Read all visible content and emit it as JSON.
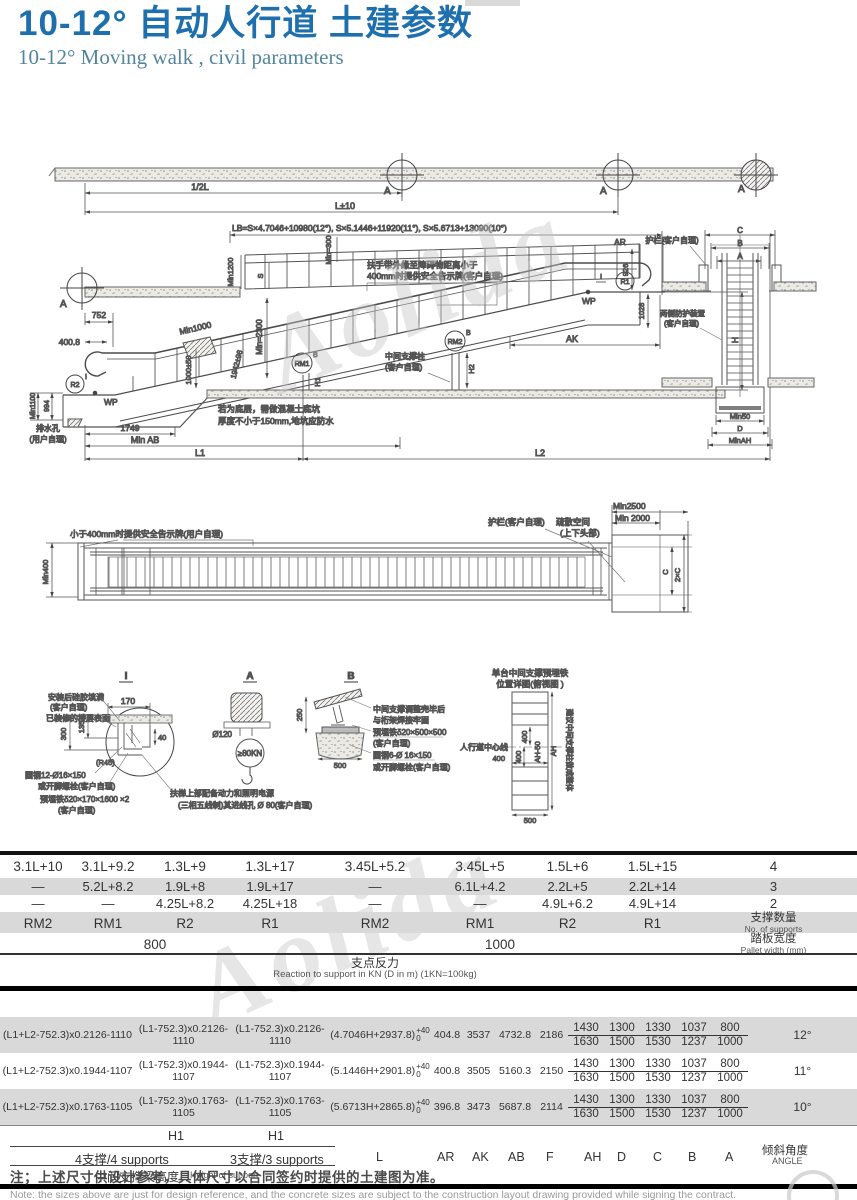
{
  "colors": {
    "title_blue": "#1e6fae",
    "subtitle_blue": "#54859e",
    "band_gray": "#d9d9d9",
    "line_dark": "#1a1a1a"
  },
  "watermark": "Aolida",
  "header": {
    "title_main": "10-12° 自动人行道",
    "title_sub": "土建参数",
    "subtitle": "10-12°  Moving walk , civil parameters"
  },
  "elevation": {
    "a_marker": "A",
    "dim_half_l": "1/2L",
    "dim_l": "L±10",
    "lb_formula": "LB=S×4.7046+10980(12°),  S×5.1446+11920(11°), S×5.6713+13090(10°)",
    "min1200": "Min1200",
    "s": "S",
    "min300": "Min=300",
    "handrail_note_1": "扶手带外缘至障碍物距离小于",
    "handrail_note_2": "400mm时提供安全告示牌(客户自理)",
    "min2300": "Min=2300",
    "min1000": "Min1000",
    "pit_depth": "1000±50",
    "incline_dim": "1942±98",
    "dim_752": "752",
    "dim_400_8": "400.8",
    "min1100": "Min1100",
    "dim_994": "994",
    "wp": "WP",
    "r2": "R2",
    "sup_i": "I",
    "r1": "R1",
    "rm1": "RM1",
    "rm2": "RM2",
    "sup_b": "B",
    "marker_i": "I",
    "drain_1": "排水孔",
    "drain_2": "(用户自理)",
    "dim_1749": "1749",
    "min_ab": "Min AB",
    "l1": "L1",
    "l2": "L2",
    "pit_note_1": "若为底层，需做混凝土底坑",
    "pit_note_2": "厚度不小于150mm,地坑应防水",
    "mid_col_1": "中间支撑柱",
    "mid_col_2": "(客户自理)",
    "h1": "H1",
    "h2": "H2",
    "ar": "AR",
    "dim_926": "926",
    "dim_1028": "1028",
    "ak": "AK",
    "h": "H"
  },
  "section": {
    "guardrail": "护栏(客户自理)",
    "c": "C",
    "b": "B",
    "a": "A",
    "side_1": "两侧防护装置",
    "side_2": "(客户自理)",
    "min50": "Min50",
    "d": "D",
    "min_ah": "MinAH"
  },
  "plan": {
    "sign_note": "小于400mm时提供安全告示牌(用户自理)",
    "min400": "Min400",
    "guardrail": "护栏(客户自理)",
    "evac_1": "疏散空间",
    "evac_2": "(上下头部)",
    "min2500": "Min2500",
    "min2000": "Min 2000",
    "c": "C",
    "c2": "2×C"
  },
  "details": {
    "i": {
      "title": "I",
      "silicone_1": "安装后硅胶填满",
      "silicone_2": "(客户自理)",
      "floor": "已装修的楼层表面",
      "d170": "170",
      "d135": "135",
      "d300": "300",
      "d40": "40",
      "r45": "(R45)",
      "rod": "圆钢12-Ø16×150",
      "bolt": "或开脚螺栓(客户自理)",
      "plate": "预埋铁δ20×170×1600 ×2",
      "owner": "(客户自理)",
      "power_1": "扶梯上部配备动力和照明电源",
      "power_2": "(三相五线制)其进线孔 Ø 80(客户自理)"
    },
    "a": {
      "title": "A",
      "d120": "Ø120",
      "load": "≥80KN"
    },
    "b": {
      "title": "B",
      "d250": "250",
      "d500": "500",
      "weld_1": "中间支撑调整完毕后",
      "weld_2": "与桁架焊接牢固",
      "plate": "预埋铁δ20×500×500",
      "owner": "(客户自理)",
      "rod": "圆钢6-Ø 16×150",
      "bolt": "或开脚螺栓(客户自理)"
    },
    "plate": {
      "title_1": "单台中间支撑预埋铁",
      "title_2": "位置详图(俯视图 )",
      "centerline": "人行道中心线",
      "d400a": "400",
      "d400b": "400",
      "d400c": "400",
      "ah50": "AH-50",
      "ah": "AH",
      "d500": "500",
      "side_note": "建议中间支撑柱做成整体"
    }
  },
  "table": {
    "header_rows": [
      [
        "3.1L+10",
        "3.1L+9.2",
        "1.3L+9",
        "1.3L+17",
        "3.45L+5.2",
        "3.45L+5",
        "1.5L+6",
        "1.5L+15",
        "4"
      ],
      [
        "—",
        "5.2L+8.2",
        "1.9L+8",
        "1.9L+17",
        "—",
        "6.1L+4.2",
        "2.2L+5",
        "2.2L+14",
        "3"
      ],
      [
        "—",
        "—",
        "4.25L+8.2",
        "4.25L+18",
        "—",
        "—",
        "4.9L+6.2",
        "4.9L+14",
        "2"
      ],
      [
        "RM2",
        "RM1",
        "R2",
        "R1",
        "RM2",
        "RM1",
        "R2",
        "R1"
      ]
    ],
    "supports_zh": "支撑数量",
    "supports_en": "No. of supports",
    "span_800": "800",
    "span_1000": "1000",
    "pallet_zh": "踏板宽度",
    "pallet_en": "Pallet width (mm)",
    "reaction_zh": "支点反力",
    "reaction_en": "Reaction to support in KN (D in m)  (1KN=100kg)",
    "formula_rows": [
      {
        "f1": "(L1+L2-752.3)x0.2126-1110",
        "f2": "(L1-752.3)x0.2126-1110",
        "f3": "(L1-752.3)x0.2126-1110",
        "f4": "(4.7046H+2937.8)",
        "tol_top": "+40",
        "tol_bot": "0",
        "v1": "404.8",
        "v2": "3537",
        "v3": "4732.8",
        "v4": "2186",
        "angle": "12°"
      },
      {
        "f1": "(L1+L2-752.3)x0.1944-1107",
        "f2": "(L1-752.3)x0.1944-1107",
        "f3": "(L1-752.3)x0.1944-1107",
        "f4": "(5.1446H+2901.8)",
        "tol_top": "+40",
        "tol_bot": "0",
        "v1": "400.8",
        "v2": "3505",
        "v3": "5160.3",
        "v4": "2150",
        "angle": "11°"
      },
      {
        "f1": "(L1+L2-752.3)x0.1763-1105",
        "f2": "(L1-752.3)x0.1763-1105",
        "f3": "(L1-752.3)x0.1763-1105",
        "f4": "(5.6713H+2865.8)",
        "tol_top": "+40",
        "tol_bot": "0",
        "v1": "396.8",
        "v2": "3473",
        "v3": "5687.8",
        "v4": "2114",
        "angle": "10°"
      }
    ],
    "fractions": [
      {
        "top": "1430",
        "bot": "1630"
      },
      {
        "top": "1300",
        "bot": "1500"
      },
      {
        "top": "1330",
        "bot": "1530"
      },
      {
        "top": "1037",
        "bot": "1237"
      },
      {
        "top": "800",
        "bot": "1000"
      }
    ],
    "footer": {
      "h_labels": [
        "H2",
        "H1",
        "H1"
      ],
      "support_labels": [
        "4支撑/4 supports",
        "3支撑/3 supports"
      ],
      "l_label": "L",
      "dim_labels": [
        "AR",
        "AK",
        "AB",
        "F",
        "AH",
        "D",
        "C",
        "B",
        "A"
      ],
      "angle_zh": "倾斜角度",
      "angle_en": "ANGLE",
      "height_zh": "中间支撑梁高度",
      "height_en": "Height of support"
    }
  },
  "note": {
    "zh": "注；上述尺寸供设计参考，具体尺寸以合同签约时提供的土建图为准。",
    "en": "Note: the sizes above are just for design reference, and the concrete sizes are subject to the construction layout drawing provided while signing the contract."
  }
}
